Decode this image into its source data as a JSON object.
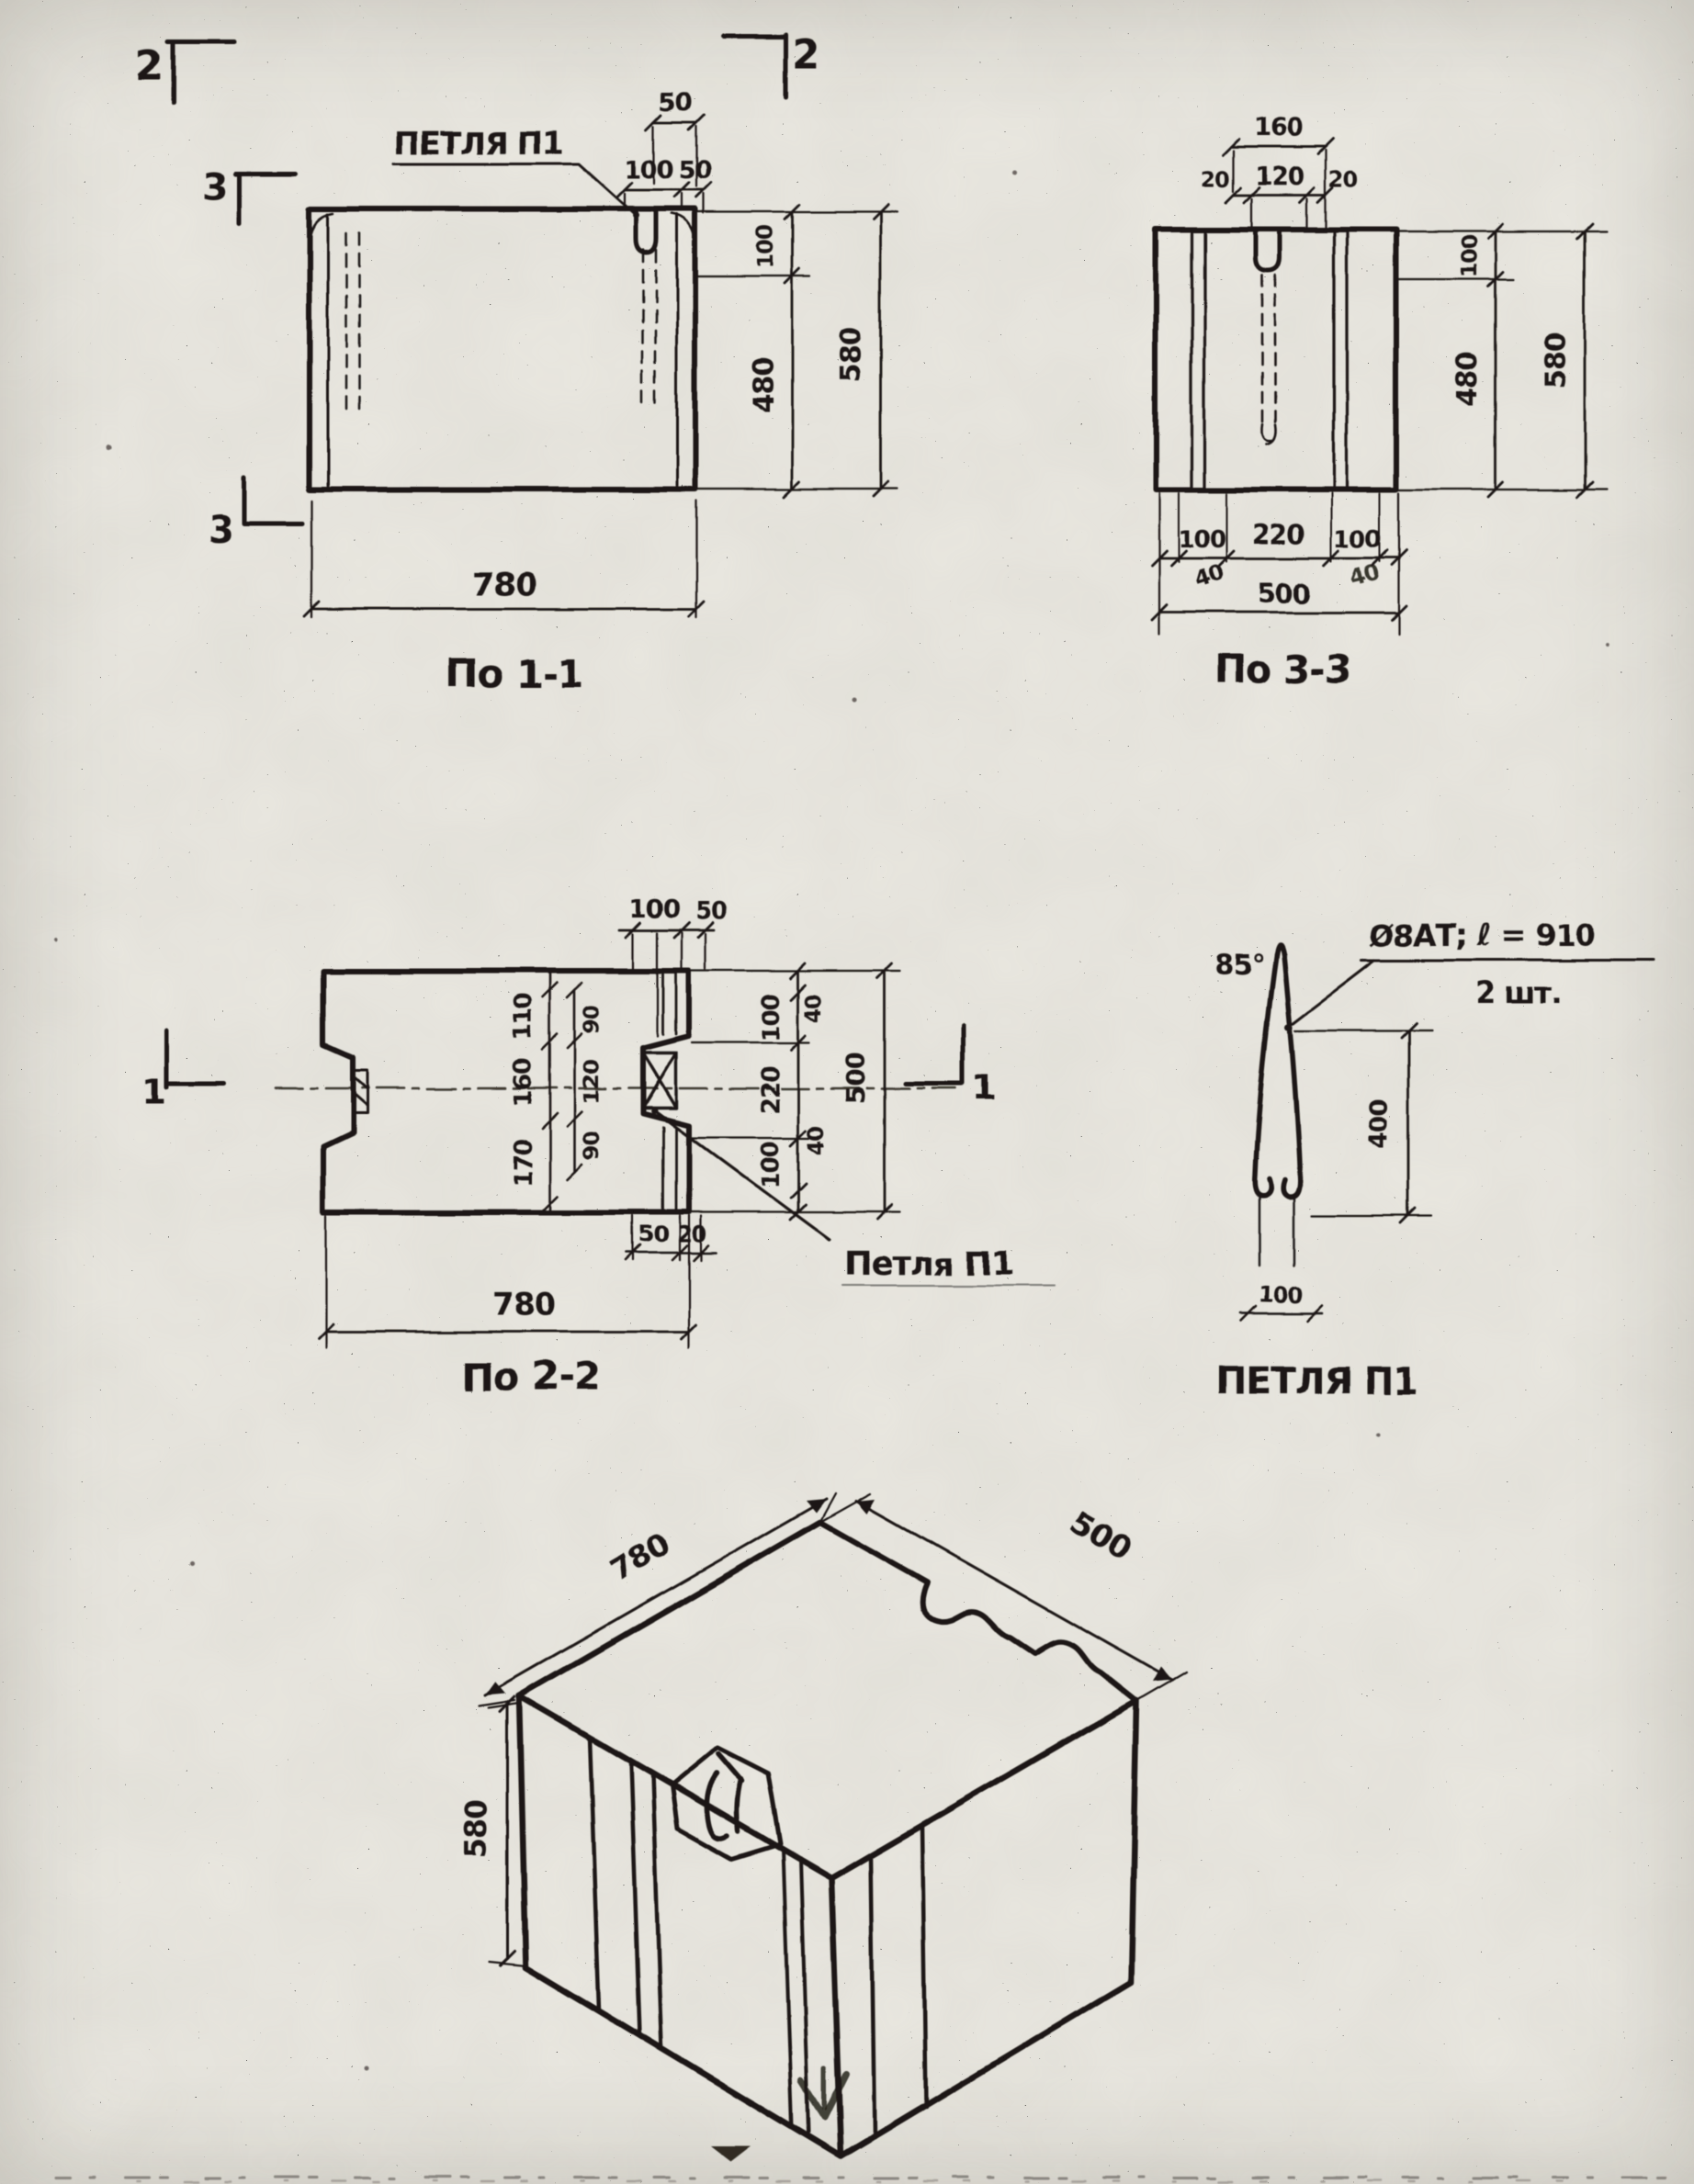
{
  "marks": {
    "sec2_left": "2",
    "sec2_right": "2",
    "sec3_upper": "3",
    "sec3_lower": "3",
    "sec1_left": "1",
    "sec1_right": "1"
  },
  "view_1_1": {
    "title": "По 1-1",
    "loop_label": "ПЕТЛЯ П1",
    "dim_top_50a": "50",
    "dim_top_100": "100",
    "dim_top_50b": "50",
    "dim_right_100": "100",
    "dim_right_480": "480",
    "dim_right_580": "580",
    "dim_bottom_780": "780"
  },
  "view_3_3": {
    "title": "По 3-3",
    "dim_top_160": "160",
    "dim_top_20l": "20",
    "dim_top_120": "120",
    "dim_top_20r": "20",
    "dim_right_100": "100",
    "dim_right_480": "480",
    "dim_right_580": "580",
    "dim_bot_100l": "100",
    "dim_bot_220": "220",
    "dim_bot_100r": "100",
    "dim_bot_40l": "40",
    "dim_bot_40r": "40",
    "dim_bot_500": "500"
  },
  "view_2_2": {
    "title": "По 2-2",
    "loop_label": "Петля П1",
    "dim_top_100": "100",
    "dim_top_50": "50",
    "col_a": [
      "110",
      "160",
      "170"
    ],
    "col_b": [
      "90",
      "120",
      "90"
    ],
    "right_40t": "40",
    "right_100t": "100",
    "right_220": "220",
    "right_100b": "100",
    "right_40b": "40",
    "right_500": "500",
    "notch_50": "50",
    "notch_20": "20",
    "dim_bottom_780": "780"
  },
  "loop_detail": {
    "title": "ПЕТЛЯ П1",
    "angle_note": "85°",
    "spec_line1": "Ø8АТ; ℓ = 910",
    "spec_line2": "2 шт.",
    "dim_400": "400",
    "dim_100": "100"
  },
  "isometric": {
    "dim_780": "780",
    "dim_500": "500",
    "dim_580": "580"
  }
}
